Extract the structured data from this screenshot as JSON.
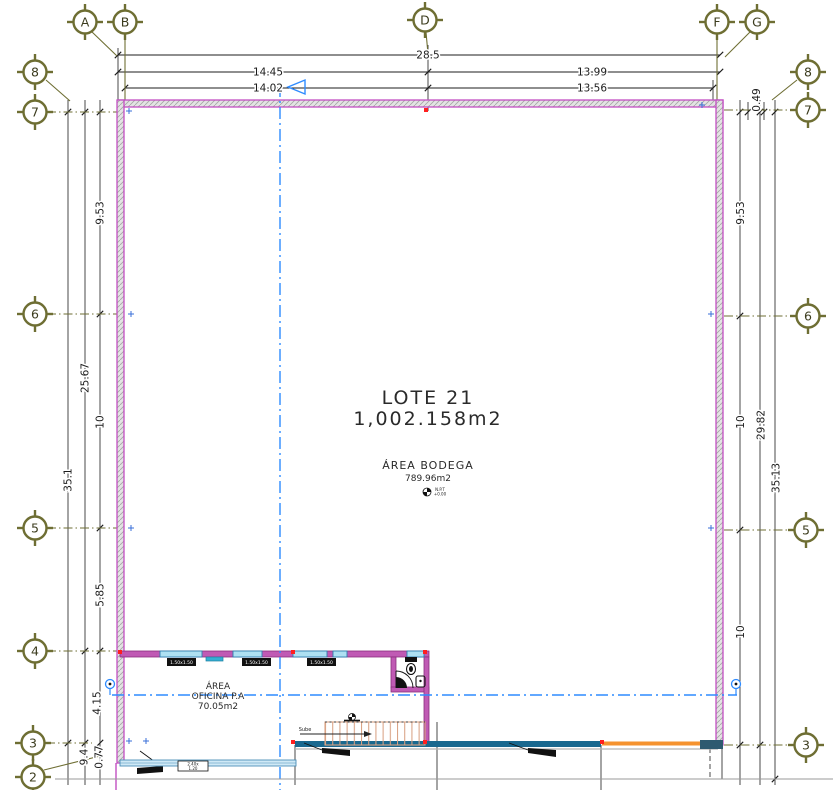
{
  "drawing": {
    "lote": {
      "title": "LOTE  21",
      "area": "1,002.158m2"
    },
    "bodega": {
      "title": "ÁREA BODEGA",
      "area": "789.96m2",
      "level_line1": "N.P.T",
      "level_line2": "+0.00"
    },
    "oficina": {
      "line1": "ÁREA",
      "line2": "OFICINA P.A",
      "line3": "70.05m2"
    },
    "stairs_label": "Sube",
    "window_tags": [
      "1.50x1.50",
      "1.50x1.50",
      "1.50x1.50"
    ],
    "door_tag": {
      "line1": "2.40x",
      "line2": "1.20"
    }
  },
  "grid": {
    "top": [
      "A",
      "B",
      "D",
      "F",
      "G"
    ],
    "left": [
      "8",
      "7",
      "6",
      "5",
      "4",
      "3",
      "2"
    ],
    "right": [
      "8",
      "7",
      "6",
      "5",
      "3"
    ]
  },
  "dims": {
    "top_total": "28.5",
    "top_left_outer": "14.45",
    "top_left_inner": "14.02",
    "top_right_outer": "13.99",
    "top_right_inner": "13.56",
    "top_corner": "0.49",
    "left_upper": "9.53",
    "left_mid": "10",
    "left_span": "25.67",
    "left_total": "35.1",
    "left_lower": "5.85",
    "left_office": "4.15",
    "left_bottom_a": "9.4",
    "left_bottom_b": "0.77",
    "right_upper": "9.53",
    "right_mid": "10",
    "right_lower": "10",
    "right_span": "29.82",
    "right_total": "35.13"
  },
  "colors": {
    "wall_magenta": "#c24fc2",
    "grid_bubble_olive": "#6e6e33",
    "centerline_blue": "#2e8bff",
    "deck_teal": "#19688f",
    "accent_orange": "#f5922e",
    "stair_tan": "#d9a284",
    "window_blue": "#aee0f2",
    "marker_red": "#ff1f1f"
  }
}
